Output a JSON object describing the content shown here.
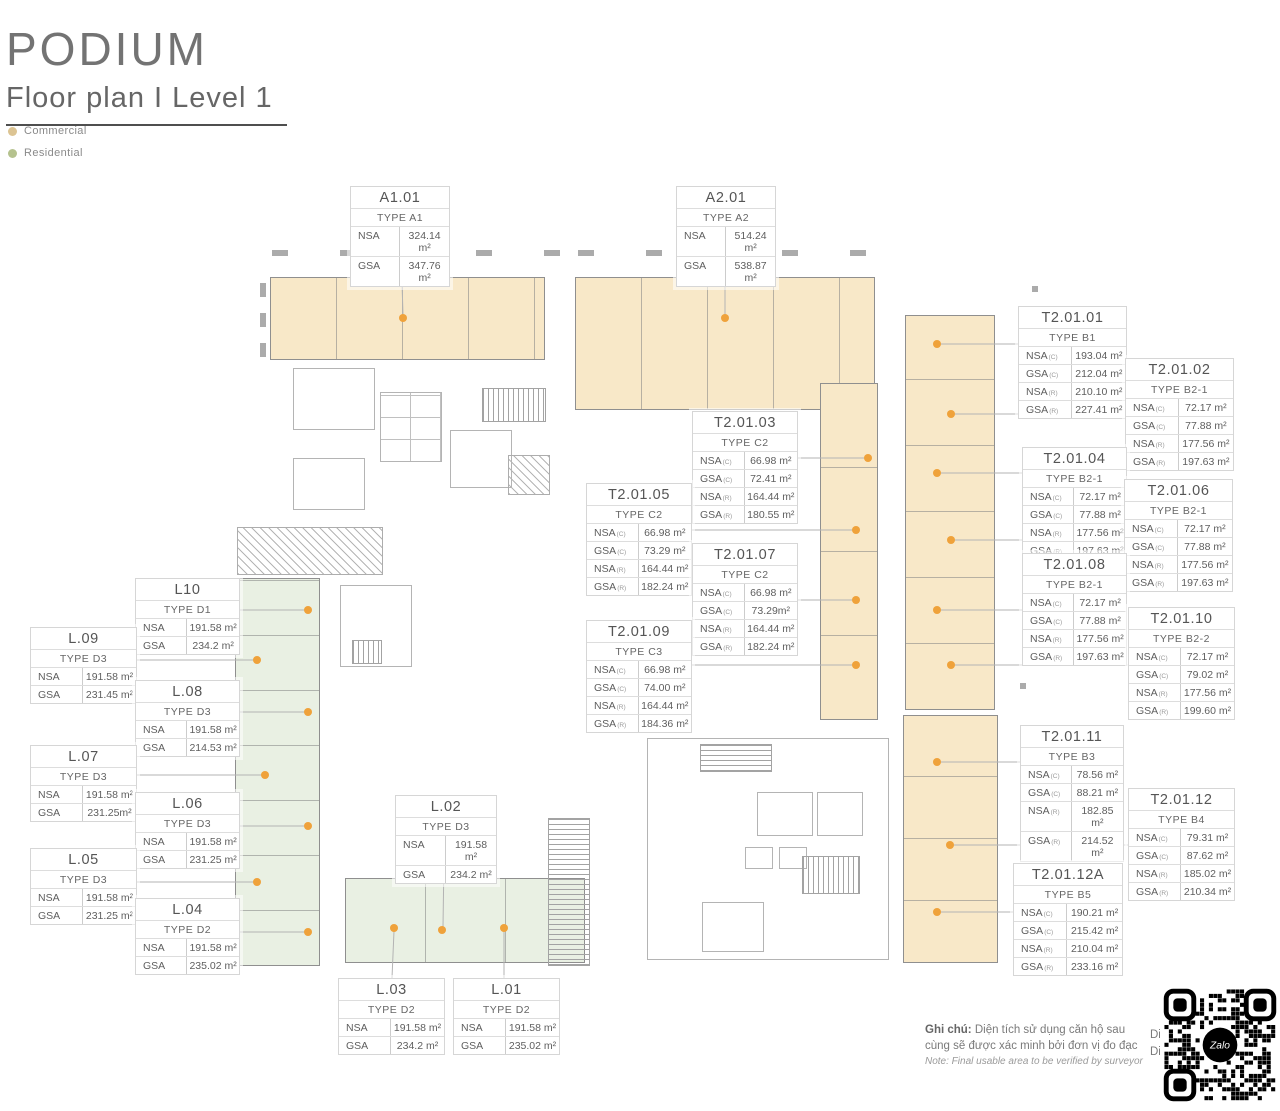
{
  "page": {
    "title": "PODIUM",
    "subtitle": "Floor plan I  Level 1"
  },
  "legend": {
    "items": [
      {
        "id": "commercial",
        "label": "Commercial",
        "color": "#DCC493"
      },
      {
        "id": "residential",
        "label": "Residential",
        "color": "#B5C28E"
      }
    ]
  },
  "colors": {
    "commercial_fill": "#F8E8C8",
    "residential_fill": "#E9F0E3",
    "marker": "#EFA23B",
    "leader_line": "#b3b3b3"
  },
  "units": [
    {
      "id": "A1.01",
      "type": "TYPE A1",
      "rows": [
        {
          "label": "NSA",
          "sub": "",
          "value": "324.14 m²"
        },
        {
          "label": "GSA",
          "sub": "",
          "value": "347.76 m²"
        }
      ]
    },
    {
      "id": "A2.01",
      "type": "TYPE A2",
      "rows": [
        {
          "label": "NSA",
          "sub": "",
          "value": "514.24 m²"
        },
        {
          "label": "GSA",
          "sub": "",
          "value": "538.87 m²"
        }
      ]
    },
    {
      "id": "T2.01.01",
      "type": "TYPE B1",
      "rows": [
        {
          "label": "NSA",
          "sub": "(C)",
          "value": "193.04 m²"
        },
        {
          "label": "GSA",
          "sub": "(C)",
          "value": "212.04 m²"
        },
        {
          "label": "NSA",
          "sub": "(R)",
          "value": "210.10 m²"
        },
        {
          "label": "GSA",
          "sub": "(R)",
          "value": "227.41 m²"
        }
      ]
    },
    {
      "id": "T2.01.02",
      "type": "TYPE B2-1",
      "rows": [
        {
          "label": "NSA",
          "sub": "(C)",
          "value": "72.17 m²"
        },
        {
          "label": "GSA",
          "sub": "(C)",
          "value": "77.88 m²"
        },
        {
          "label": "NSA",
          "sub": "(R)",
          "value": "177.56 m²"
        },
        {
          "label": "GSA",
          "sub": "(R)",
          "value": "197.63 m²"
        }
      ]
    },
    {
      "id": "T2.01.03",
      "type": "TYPE C2",
      "rows": [
        {
          "label": "NSA",
          "sub": "(C)",
          "value": "66.98 m²"
        },
        {
          "label": "GSA",
          "sub": "(C)",
          "value": "72.41 m²"
        },
        {
          "label": "NSA",
          "sub": "(R)",
          "value": "164.44 m²"
        },
        {
          "label": "GSA",
          "sub": "(R)",
          "value": "180.55 m²"
        }
      ]
    },
    {
      "id": "T2.01.04",
      "type": "TYPE B2-1",
      "rows": [
        {
          "label": "NSA",
          "sub": "(C)",
          "value": "72.17 m²"
        },
        {
          "label": "GSA",
          "sub": "(C)",
          "value": "77.88 m²"
        },
        {
          "label": "NSA",
          "sub": "(R)",
          "value": "177.56 m²"
        },
        {
          "label": "GSA",
          "sub": "(R)",
          "value": "197.63 m²"
        }
      ]
    },
    {
      "id": "T2.01.05",
      "type": "TYPE C2",
      "rows": [
        {
          "label": "NSA",
          "sub": "(C)",
          "value": "66.98 m²"
        },
        {
          "label": "GSA",
          "sub": "(C)",
          "value": "73.29 m²"
        },
        {
          "label": "NSA",
          "sub": "(R)",
          "value": "164.44 m²"
        },
        {
          "label": "GSA",
          "sub": "(R)",
          "value": "182.24 m²"
        }
      ]
    },
    {
      "id": "T2.01.06",
      "type": "TYPE B2-1",
      "rows": [
        {
          "label": "NSA",
          "sub": "(C)",
          "value": "72.17 m²"
        },
        {
          "label": "GSA",
          "sub": "(C)",
          "value": "77.88 m²"
        },
        {
          "label": "NSA",
          "sub": "(R)",
          "value": "177.56 m²"
        },
        {
          "label": "GSA",
          "sub": "(R)",
          "value": "197.63 m²"
        }
      ]
    },
    {
      "id": "T2.01.07",
      "type": "TYPE C2",
      "rows": [
        {
          "label": "NSA",
          "sub": "(C)",
          "value": "66.98 m²"
        },
        {
          "label": "GSA",
          "sub": "(C)",
          "value": "73.29m²"
        },
        {
          "label": "NSA",
          "sub": "(R)",
          "value": "164.44 m²"
        },
        {
          "label": "GSA",
          "sub": "(R)",
          "value": "182.24 m²"
        }
      ]
    },
    {
      "id": "T2.01.08",
      "type": "TYPE B2-1",
      "rows": [
        {
          "label": "NSA",
          "sub": "(C)",
          "value": "72.17 m²"
        },
        {
          "label": "GSA",
          "sub": "(C)",
          "value": "77.88 m²"
        },
        {
          "label": "NSA",
          "sub": "(R)",
          "value": "177.56 m²"
        },
        {
          "label": "GSA",
          "sub": "(R)",
          "value": "197.63 m²"
        }
      ]
    },
    {
      "id": "T2.01.09",
      "type": "TYPE C3",
      "rows": [
        {
          "label": "NSA",
          "sub": "(C)",
          "value": "66.98 m²"
        },
        {
          "label": "GSA",
          "sub": "(C)",
          "value": "74.00 m²"
        },
        {
          "label": "NSA",
          "sub": "(R)",
          "value": "164.44 m²"
        },
        {
          "label": "GSA",
          "sub": "(R)",
          "value": "184.36 m²"
        }
      ]
    },
    {
      "id": "T2.01.10",
      "type": "TYPE B2-2",
      "rows": [
        {
          "label": "NSA",
          "sub": "(C)",
          "value": "72.17 m²"
        },
        {
          "label": "GSA",
          "sub": "(C)",
          "value": "79.02 m²"
        },
        {
          "label": "NSA",
          "sub": "(R)",
          "value": "177.56 m²"
        },
        {
          "label": "GSA",
          "sub": "(R)",
          "value": "199.60 m²"
        }
      ]
    },
    {
      "id": "T2.01.11",
      "type": "TYPE B3",
      "rows": [
        {
          "label": "NSA",
          "sub": "(C)",
          "value": "78.56 m²"
        },
        {
          "label": "GSA",
          "sub": "(C)",
          "value": "88.21 m²"
        },
        {
          "label": "NSA",
          "sub": "(R)",
          "value": "182.85 m²"
        },
        {
          "label": "GSA",
          "sub": "(R)",
          "value": "214.52 m²"
        }
      ]
    },
    {
      "id": "T2.01.12",
      "type": "TYPE B4",
      "rows": [
        {
          "label": "NSA",
          "sub": "(C)",
          "value": "79.31 m²"
        },
        {
          "label": "GSA",
          "sub": "(C)",
          "value": "87.62 m²"
        },
        {
          "label": "NSA",
          "sub": "(R)",
          "value": "185.02 m²"
        },
        {
          "label": "GSA",
          "sub": "(R)",
          "value": "210.34 m²"
        }
      ]
    },
    {
      "id": "T2.01.12A",
      "type": "TYPE B5",
      "rows": [
        {
          "label": "NSA",
          "sub": "(C)",
          "value": "190.21 m²"
        },
        {
          "label": "GSA",
          "sub": "(C)",
          "value": "215.42 m²"
        },
        {
          "label": "NSA",
          "sub": "(R)",
          "value": "210.04 m²"
        },
        {
          "label": "GSA",
          "sub": "(R)",
          "value": "233.16 m²"
        }
      ]
    },
    {
      "id": "L10",
      "type": "TYPE D1",
      "rows": [
        {
          "label": "NSA",
          "sub": "",
          "value": "191.58 m²"
        },
        {
          "label": "GSA",
          "sub": "",
          "value": "234.2 m²"
        }
      ]
    },
    {
      "id": "L.09",
      "type": "TYPE D3",
      "rows": [
        {
          "label": "NSA",
          "sub": "",
          "value": "191.58 m²"
        },
        {
          "label": "GSA",
          "sub": "",
          "value": "231.45 m²"
        }
      ]
    },
    {
      "id": "L.08",
      "type": "TYPE D3",
      "rows": [
        {
          "label": "NSA",
          "sub": "",
          "value": "191.58 m²"
        },
        {
          "label": "GSA",
          "sub": "",
          "value": "214.53 m²"
        }
      ]
    },
    {
      "id": "L.07",
      "type": "TYPE D3",
      "rows": [
        {
          "label": "NSA",
          "sub": "",
          "value": "191.58 m²"
        },
        {
          "label": "GSA",
          "sub": "",
          "value": "231.25m²"
        }
      ]
    },
    {
      "id": "L.06",
      "type": "TYPE D3",
      "rows": [
        {
          "label": "NSA",
          "sub": "",
          "value": "191.58 m²"
        },
        {
          "label": "GSA",
          "sub": "",
          "value": "231.25 m²"
        }
      ]
    },
    {
      "id": "L.05",
      "type": "TYPE D3",
      "rows": [
        {
          "label": "NSA",
          "sub": "",
          "value": "191.58 m²"
        },
        {
          "label": "GSA",
          "sub": "",
          "value": "231.25 m²"
        }
      ]
    },
    {
      "id": "L.04",
      "type": "TYPE D2",
      "rows": [
        {
          "label": "NSA",
          "sub": "",
          "value": "191.58 m²"
        },
        {
          "label": "GSA",
          "sub": "",
          "value": "235.02 m²"
        }
      ]
    },
    {
      "id": "L.02",
      "type": "TYPE D3",
      "rows": [
        {
          "label": "NSA",
          "sub": "",
          "value": "191.58 m²"
        },
        {
          "label": "GSA",
          "sub": "",
          "value": "234.2 m²"
        }
      ]
    },
    {
      "id": "L.03",
      "type": "TYPE D2",
      "rows": [
        {
          "label": "NSA",
          "sub": "",
          "value": "191.58 m²"
        },
        {
          "label": "GSA",
          "sub": "",
          "value": "234.2 m²"
        }
      ]
    },
    {
      "id": "L.01",
      "type": "TYPE D2",
      "rows": [
        {
          "label": "NSA",
          "sub": "",
          "value": "191.58 m²"
        },
        {
          "label": "GSA",
          "sub": "",
          "value": "235.02 m²"
        }
      ]
    }
  ],
  "footnote": {
    "label_vi": "Ghi chú:",
    "text_vi": " Diện tích sử dụng căn hộ sau cùng sẽ được xác minh bởi đơn vị đo đạc",
    "text_en": "Note: Final usable area to be verified by surveyor",
    "clipped_lines": [
      "Di",
      "Di"
    ]
  },
  "qr": {
    "brand": "Zalo"
  }
}
